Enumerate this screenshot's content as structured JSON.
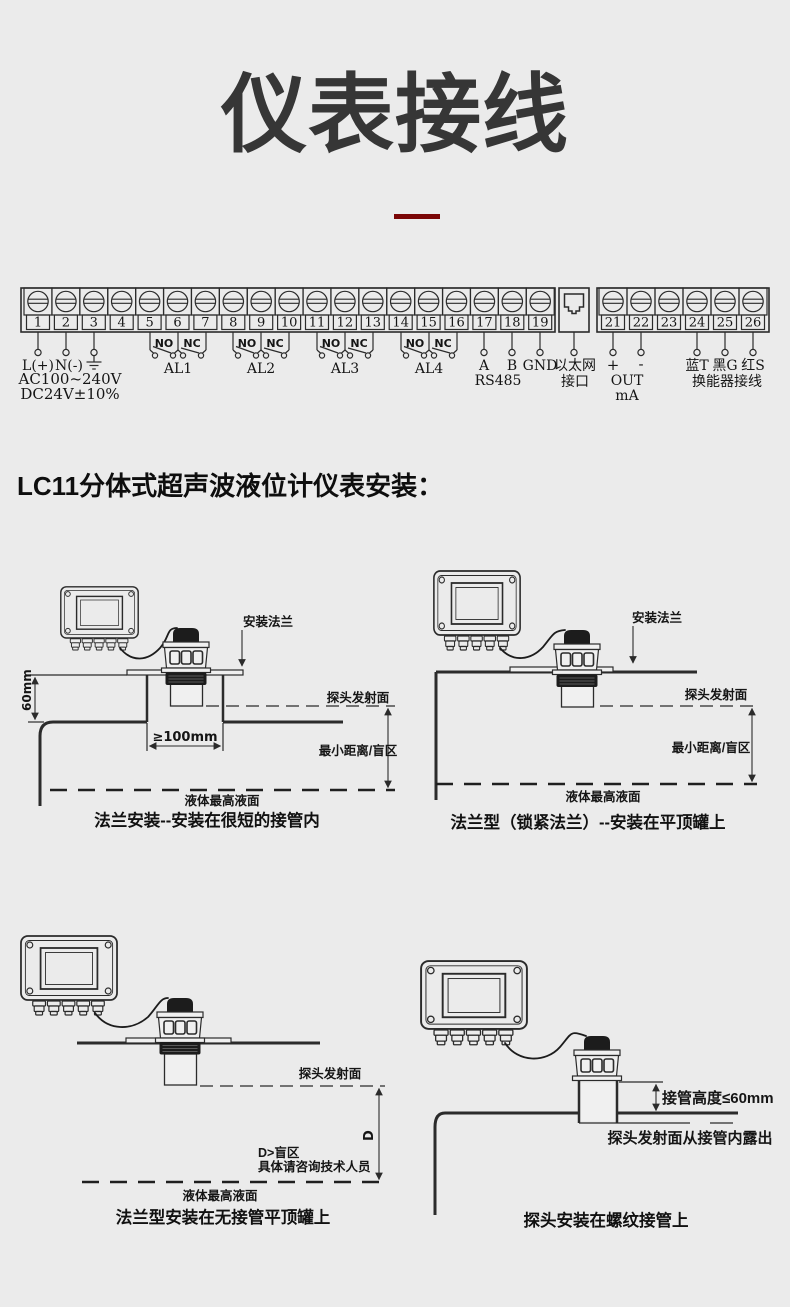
{
  "page": {
    "title": "仪表接线",
    "background": "#ebebeb",
    "accent_red": "#7a0606",
    "line_color": "#2b2b2b"
  },
  "wiring": {
    "block1_terminals": [
      "1",
      "2",
      "3",
      "4",
      "5",
      "6",
      "7",
      "8",
      "9",
      "10",
      "11",
      "12",
      "13",
      "14",
      "15",
      "16",
      "17",
      "18",
      "19"
    ],
    "block2_terminals": [
      "21",
      "22",
      "23",
      "24",
      "25",
      "26"
    ],
    "power": {
      "l": "L(+)",
      "n": "N(-)",
      "line1": "AC100~240V",
      "line2": "DC24V±10%"
    },
    "relays": {
      "no": "NO",
      "nc": "NC",
      "names": [
        "AL1",
        "AL2",
        "AL3",
        "AL4"
      ]
    },
    "rs485": {
      "a": "A",
      "b": "B",
      "gnd": "GND",
      "label": "RS485"
    },
    "ethernet": {
      "line1": "以太网",
      "line2": "接口"
    },
    "analog": {
      "plus": "+",
      "minus": "-",
      "line1": "OUT",
      "line2": "mA"
    },
    "transducer": {
      "blue": "蓝T",
      "black": "黑G",
      "red": "红S",
      "label": "换能器接线"
    }
  },
  "section": {
    "heading": "LC11分体式超声波液位计仪表安装："
  },
  "diagram1": {
    "caption": "法兰安装--安装在很短的接管内",
    "flange": "安装法兰",
    "dim_height": "60mm",
    "emit_face": "探头发射面",
    "dim_width": "≥100mm",
    "blind": "最小距离/盲区",
    "liquid": "液体最高液面"
  },
  "diagram2": {
    "caption": "法兰型（锁紧法兰）--安装在平顶罐上",
    "flange": "安装法兰",
    "emit_face": "探头发射面",
    "blind": "最小距离/盲区",
    "liquid": "液体最高液面"
  },
  "diagram3": {
    "caption": "法兰型安装在无接管平顶罐上",
    "emit_face": "探头发射面",
    "dim_d": "D",
    "blind1": "D>盲区",
    "blind2": "具体请咨询技术人员",
    "liquid": "液体最高液面"
  },
  "diagram4": {
    "caption": "探头安装在螺纹接管上",
    "pipe_height": "接管高度≤60mm",
    "expose": "探头发射面从接管内露出"
  }
}
